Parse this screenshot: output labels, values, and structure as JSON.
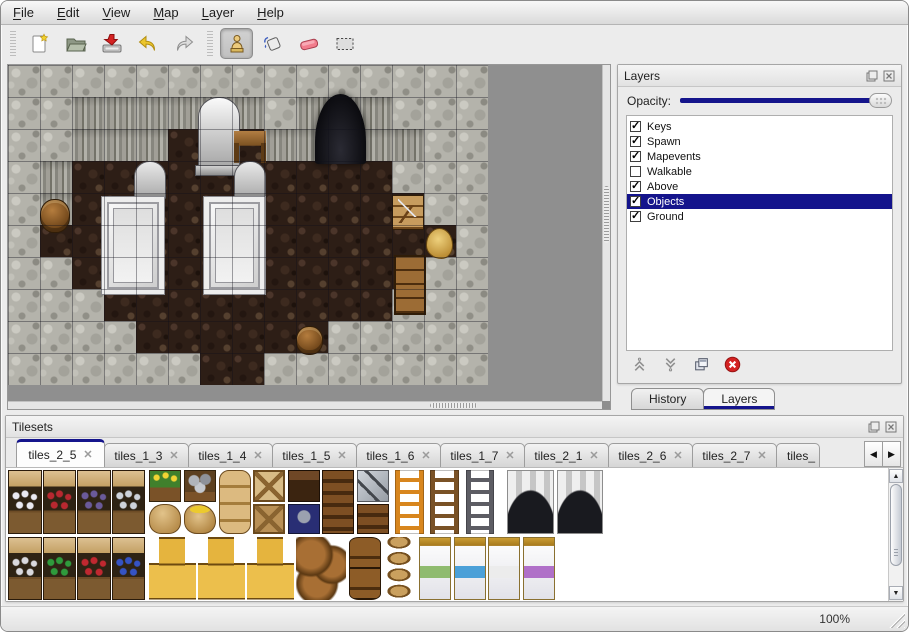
{
  "menu": {
    "items": [
      "File",
      "Edit",
      "View",
      "Map",
      "Layer",
      "Help"
    ]
  },
  "toolbar": {
    "tools": [
      "new-map",
      "open",
      "save",
      "undo",
      "redo",
      "stamp",
      "fill",
      "eraser",
      "select"
    ],
    "active_tool": "stamp"
  },
  "layers_panel": {
    "title": "Layers",
    "window_icons": [
      "float-icon",
      "close-icon"
    ],
    "opacity_label": "Opacity:",
    "opacity_percent": 100,
    "layers": [
      {
        "name": "Keys",
        "checked": true,
        "selected": false
      },
      {
        "name": "Spawn",
        "checked": true,
        "selected": false
      },
      {
        "name": "Mapevents",
        "checked": true,
        "selected": false
      },
      {
        "name": "Walkable",
        "checked": false,
        "selected": false
      },
      {
        "name": "Above",
        "checked": true,
        "selected": false
      },
      {
        "name": "Objects",
        "checked": true,
        "selected": true
      },
      {
        "name": "Ground",
        "checked": true,
        "selected": false
      }
    ],
    "actions": [
      "move-layer-up",
      "move-layer-down",
      "duplicate-layer",
      "delete-layer"
    ]
  },
  "dock_tabs": [
    {
      "label": "History",
      "active": false
    },
    {
      "label": "Layers",
      "active": true
    }
  ],
  "tilesets_panel": {
    "title": "Tilesets",
    "window_icons": [
      "float-icon",
      "close-icon"
    ],
    "tabs": [
      {
        "label": "tiles_2_5",
        "active": true,
        "truncated": false
      },
      {
        "label": "tiles_1_3",
        "active": false,
        "truncated": false
      },
      {
        "label": "tiles_1_4",
        "active": false,
        "truncated": false
      },
      {
        "label": "tiles_1_5",
        "active": false,
        "truncated": false
      },
      {
        "label": "tiles_1_6",
        "active": false,
        "truncated": false
      },
      {
        "label": "tiles_1_7",
        "active": false,
        "truncated": false
      },
      {
        "label": "tiles_2_1",
        "active": false,
        "truncated": false
      },
      {
        "label": "tiles_2_6",
        "active": false,
        "truncated": false
      },
      {
        "label": "tiles_2_7",
        "active": false,
        "truncated": false
      },
      {
        "label": "tiles_",
        "active": false,
        "truncated": true
      }
    ],
    "scroll_icons": [
      "tab-scroll-left",
      "tab-scroll-right"
    ]
  },
  "statusbar": {
    "zoom": "100%"
  },
  "colors": {
    "selection": "#14148c",
    "map_background": "#8f8f8f",
    "wall": "#b4b3ab",
    "floor": "#2d1e16",
    "eraser_pink": "#f07888",
    "delete_red": "#d02020"
  },
  "map": {
    "tile_size": 32,
    "legend": {
      "W": "rock-wall",
      "F": "cliff-face",
      ".": "wood-floor"
    },
    "grid": [
      "WWWWWWWWWWWWWWW",
      "WWFFFFFFWFFFWWW",
      "WWFFF...FFFFFWW",
      "WF..........WWW",
      "WF...........WW",
      "W.............W",
      "WW...........WW",
      "WWW.........WWW",
      "WWWW......WWWWW",
      "WWWWWW..WWWWWWW"
    ],
    "objects": [
      {
        "type": "cave",
        "x": 9.6,
        "y": 0.9,
        "w": 1.6,
        "h": 2.2
      },
      {
        "type": "statue",
        "x": 5.95,
        "y": 1.0,
        "w": 1.3,
        "h": 2.4
      },
      {
        "type": "table",
        "x": 7.05,
        "y": 2.05,
        "w": 1.0,
        "h": 1.0
      },
      {
        "type": "gravestone",
        "x": 3.95,
        "y": 3.0,
        "w": 1.0,
        "h": 1.2
      },
      {
        "type": "gravestone",
        "x": 7.05,
        "y": 3.0,
        "w": 1.0,
        "h": 1.2
      },
      {
        "type": "altar",
        "x": 2.9,
        "y": 4.1,
        "w": 2.0,
        "h": 3.1
      },
      {
        "type": "altar",
        "x": 6.1,
        "y": 4.1,
        "w": 1.95,
        "h": 3.1
      },
      {
        "type": "barrel",
        "x": 1.0,
        "y": 4.2,
        "w": 0.95,
        "h": 1.05
      },
      {
        "type": "toolshelf",
        "x": 12.0,
        "y": 4.05,
        "w": 1.0,
        "h": 1.1
      },
      {
        "type": "skull",
        "x": 13.05,
        "y": 5.1,
        "w": 0.85,
        "h": 0.95
      },
      {
        "type": "cabinet",
        "x": 12.05,
        "y": 5.95,
        "w": 1.0,
        "h": 1.85
      },
      {
        "type": "barrel",
        "x": 9.0,
        "y": 8.15,
        "w": 0.85,
        "h": 0.9
      }
    ]
  },
  "tileset_tiles": [
    {
      "type": "shelf",
      "x": 0,
      "y": 0,
      "w": 1.05,
      "h": 2,
      "color": "#e9e9f2"
    },
    {
      "type": "shelf",
      "x": 1.08,
      "y": 0,
      "w": 1.05,
      "h": 2,
      "color": "#b82830"
    },
    {
      "type": "shelf",
      "x": 2.16,
      "y": 0,
      "w": 1.05,
      "h": 2,
      "color": "#6a5a9a"
    },
    {
      "type": "shelf",
      "x": 3.24,
      "y": 0,
      "w": 1.05,
      "h": 2,
      "color": "#cdd2da"
    },
    {
      "type": "planter",
      "x": 4.42,
      "y": 0,
      "w": 1,
      "h": 1
    },
    {
      "type": "sack",
      "x": 4.42,
      "y": 1.05,
      "w": 1,
      "h": 0.95
    },
    {
      "type": "rockbox",
      "x": 5.5,
      "y": 0,
      "w": 1,
      "h": 1
    },
    {
      "type": "sack_open",
      "x": 5.5,
      "y": 1.05,
      "w": 1,
      "h": 0.95
    },
    {
      "type": "sack_stack",
      "x": 6.58,
      "y": 0,
      "w": 1,
      "h": 2
    },
    {
      "type": "crate_x",
      "x": 7.66,
      "y": 0,
      "w": 1,
      "h": 1,
      "color": "#d8bc86"
    },
    {
      "type": "crate_x",
      "x": 7.66,
      "y": 1.05,
      "w": 1,
      "h": 0.95,
      "color": "#b99055"
    },
    {
      "type": "chest_dark",
      "x": 8.74,
      "y": 0,
      "w": 1,
      "h": 1
    },
    {
      "type": "box_blue",
      "x": 8.74,
      "y": 1.05,
      "w": 1,
      "h": 0.95
    },
    {
      "type": "crate_banded",
      "x": 9.82,
      "y": 0,
      "w": 1,
      "h": 2
    },
    {
      "type": "box_z4",
      "x": 10.9,
      "y": 0,
      "w": 1,
      "h": 1
    },
    {
      "type": "crate_banded",
      "x": 10.9,
      "y": 1.05,
      "w": 1,
      "h": 0.95
    },
    {
      "type": "ladder",
      "x": 12.1,
      "y": 0,
      "w": 0.9,
      "h": 2,
      "color": "#d8861e"
    },
    {
      "type": "ladder",
      "x": 13.2,
      "y": 0,
      "w": 0.9,
      "h": 2,
      "color": "#7a5226"
    },
    {
      "type": "ladder",
      "x": 14.3,
      "y": 0,
      "w": 0.9,
      "h": 2,
      "color": "#5d5d64"
    },
    {
      "type": "cave_arch",
      "x": 15.6,
      "y": 0,
      "w": 1.45,
      "h": 2
    },
    {
      "type": "cave_arch",
      "x": 17.15,
      "y": 0,
      "w": 1.45,
      "h": 2
    },
    {
      "type": "shelf",
      "x": 0,
      "y": 2.1,
      "w": 1.05,
      "h": 1.95,
      "color": "#d9d9de"
    },
    {
      "type": "shelf",
      "x": 1.08,
      "y": 2.1,
      "w": 1.05,
      "h": 1.95,
      "color": "#2f9a3c"
    },
    {
      "type": "shelf",
      "x": 2.16,
      "y": 2.1,
      "w": 1.05,
      "h": 1.95,
      "color": "#c02830"
    },
    {
      "type": "shelf",
      "x": 3.24,
      "y": 2.1,
      "w": 1.05,
      "h": 1.95,
      "color": "#3553c4"
    },
    {
      "type": "crate_pile",
      "x": 4.42,
      "y": 2.1,
      "w": 1.45,
      "h": 1.95
    },
    {
      "type": "crate_pile",
      "x": 5.95,
      "y": 2.1,
      "w": 1.45,
      "h": 1.95
    },
    {
      "type": "crate_pile",
      "x": 7.48,
      "y": 2.1,
      "w": 1.45,
      "h": 1.95
    },
    {
      "type": "barrel_pile",
      "x": 9.0,
      "y": 2.1,
      "w": 1.55,
      "h": 1.95
    },
    {
      "type": "barrel_upright",
      "x": 10.65,
      "y": 2.1,
      "w": 1,
      "h": 1.95
    },
    {
      "type": "pot_stack",
      "x": 11.73,
      "y": 2.1,
      "w": 1,
      "h": 1.95
    },
    {
      "type": "bed",
      "x": 12.85,
      "y": 2.1,
      "w": 1,
      "h": 1.95,
      "color": "#8fbb6f"
    },
    {
      "type": "bed",
      "x": 13.93,
      "y": 2.1,
      "w": 1,
      "h": 1.95,
      "color": "#4ba0d8"
    },
    {
      "type": "bed",
      "x": 15.01,
      "y": 2.1,
      "w": 1,
      "h": 1.95,
      "color": "#ececec"
    },
    {
      "type": "bed",
      "x": 16.09,
      "y": 2.1,
      "w": 1,
      "h": 1.95,
      "color": "#b070c8"
    }
  ]
}
